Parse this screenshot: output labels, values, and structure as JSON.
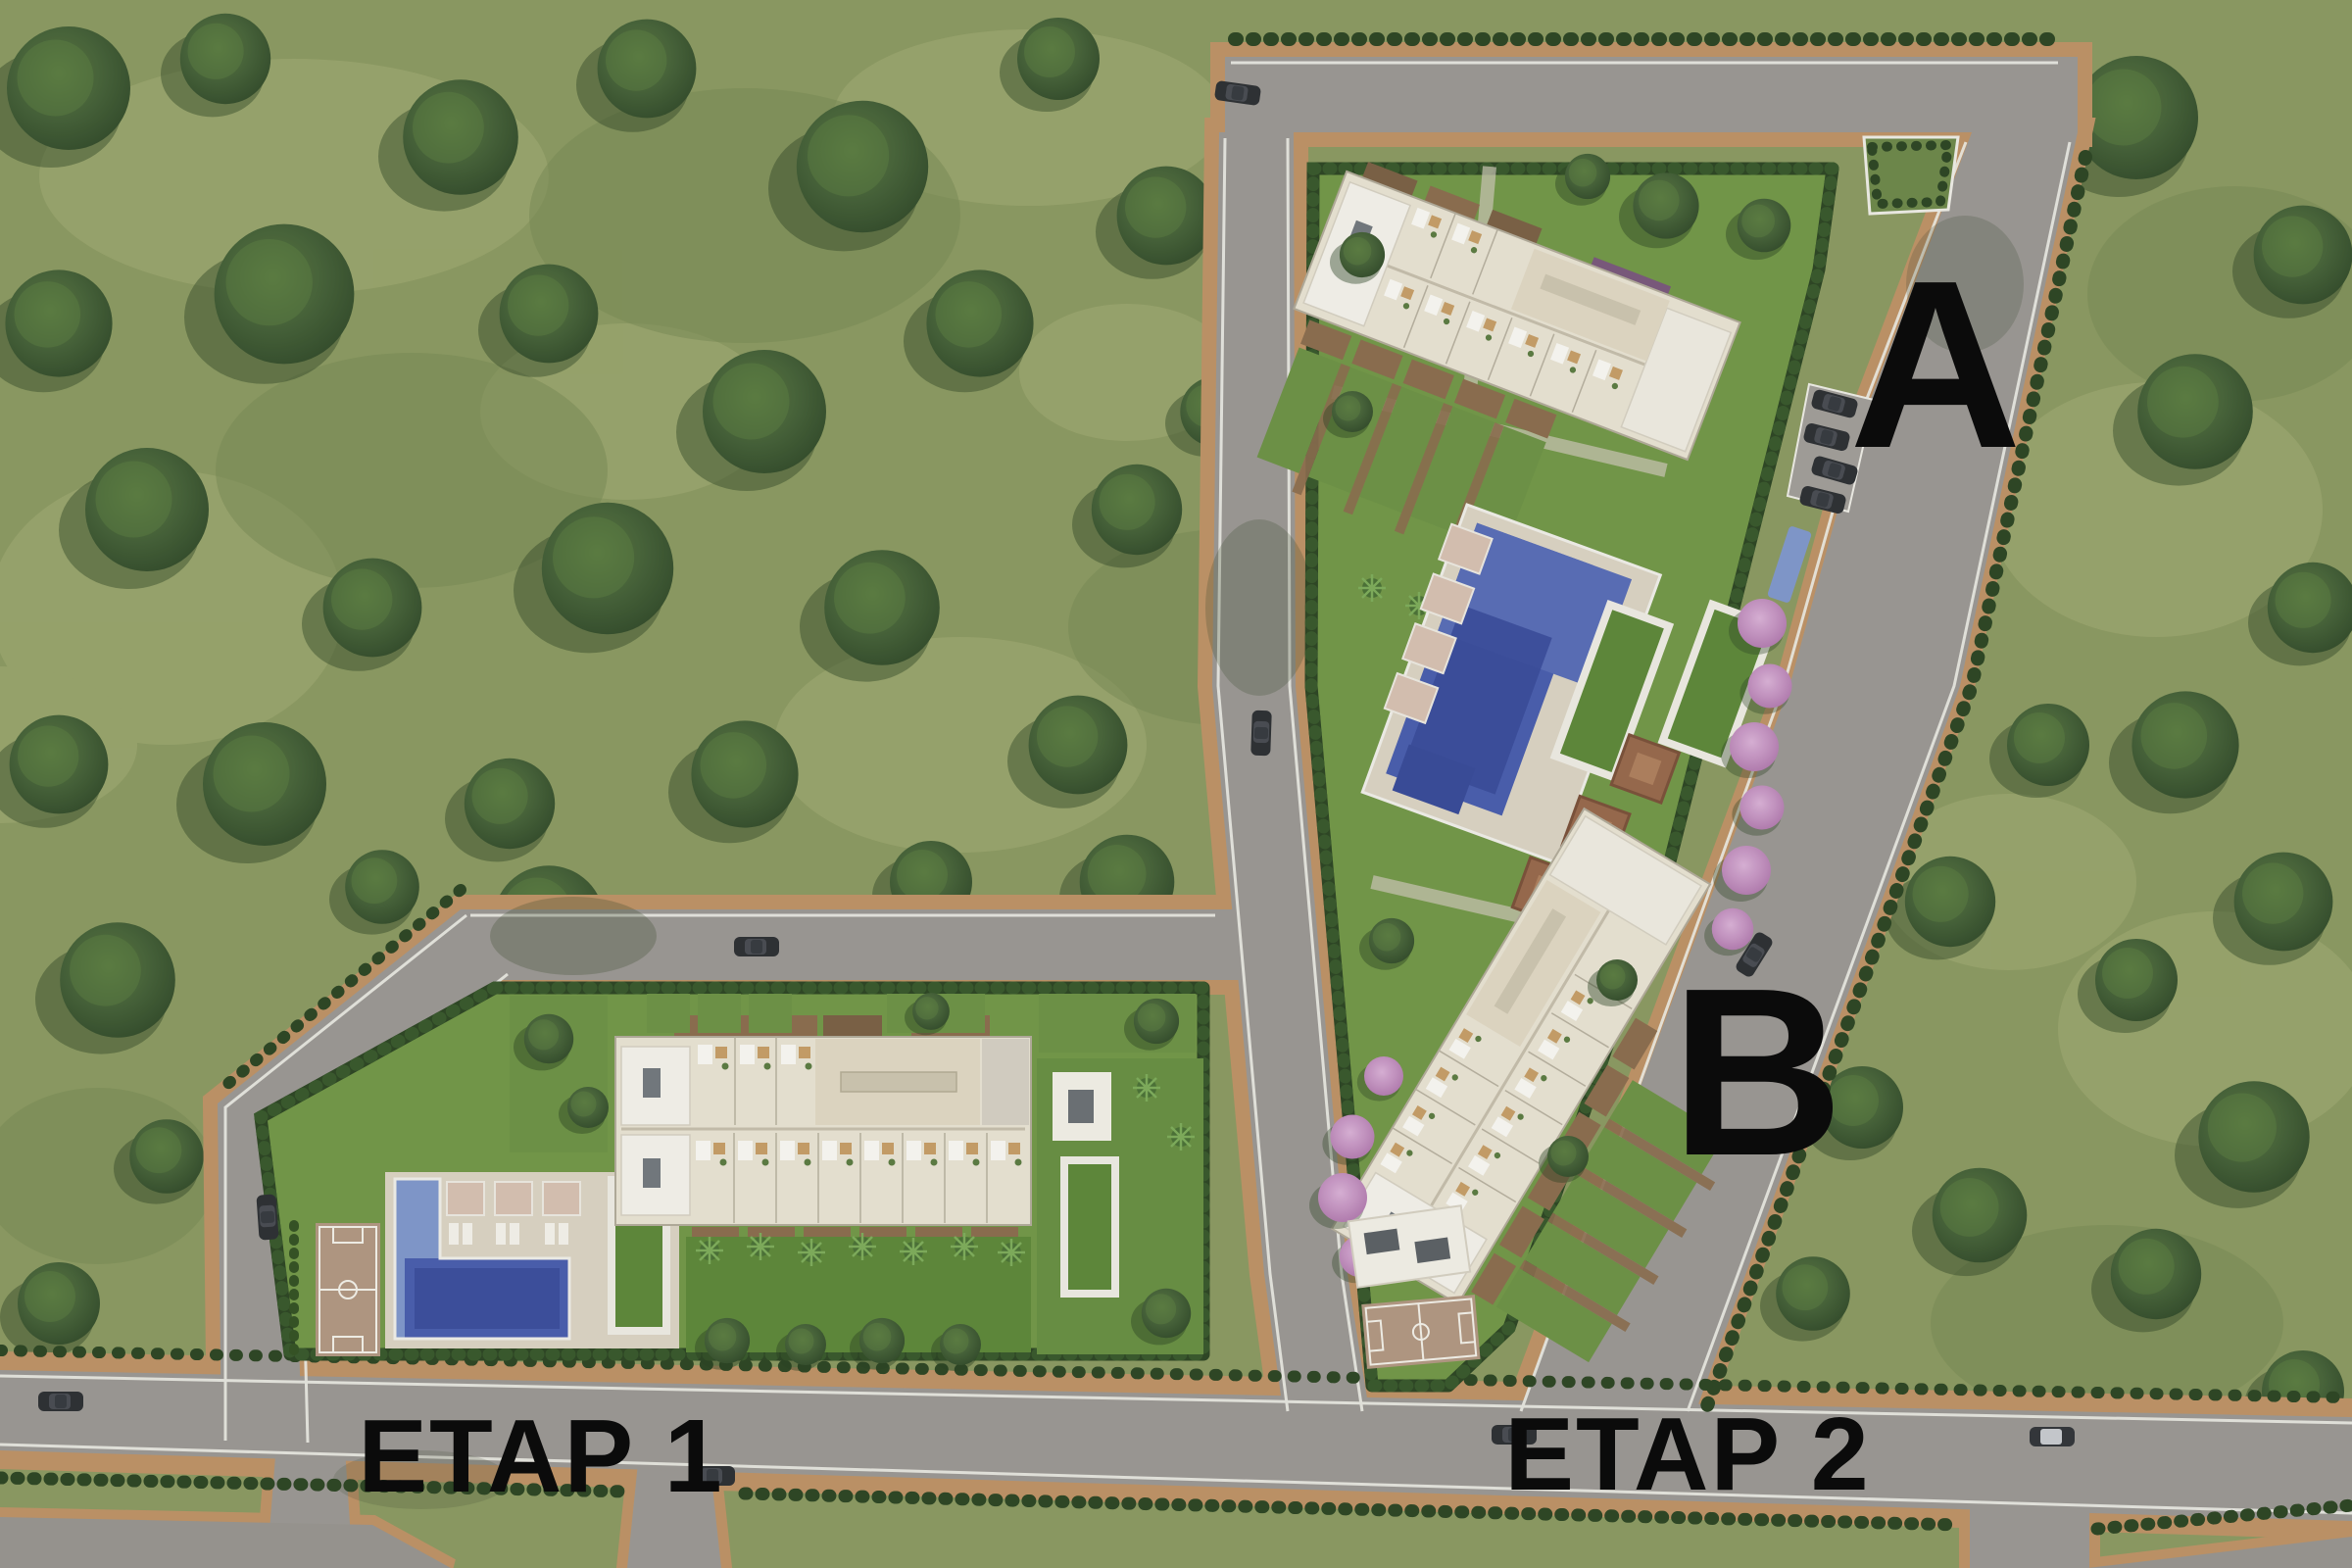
{
  "scene": {
    "type": "aerial-site-plan-render",
    "phases": [
      "ETAP 1",
      "ETAP 2"
    ],
    "blocks": [
      "A",
      "B"
    ]
  },
  "labels": {
    "block_a": "A",
    "block_b": "B",
    "phase1": "ETAP 1",
    "phase2": "ETAP 2"
  },
  "features": {
    "phase1": [
      "townhouse-row-building",
      "l-shaped-pool",
      "basketball-court",
      "green-roof-pavilions",
      "lawn"
    ],
    "phase2": [
      "block-a-townhouse-row",
      "central-pool-terrace",
      "pergolas",
      "block-b-townhouse-row",
      "basketball-court",
      "pink-flowering-trees"
    ],
    "visible_vehicle_count": 13
  },
  "colors": {
    "forest_grass": "#8d9c64",
    "grass_patch": "#a7b079",
    "tree_canopy": "#45613a",
    "road": "#9d9a96",
    "sidewalk": "#c09469",
    "curb_line": "#f0efe9",
    "hedge": "#2e4726",
    "parcel_lawn": "#74994a",
    "lawn_dark": "#5f8a3c",
    "building": "#ebe5d6",
    "roof_white": "#f6f4ee",
    "terrace": "#e2dac6",
    "deck_brown": "#8d6f51",
    "pool_blue": "#4a5fb0",
    "pool_dark": "#3a4c9c",
    "pool_light": "#8299cf",
    "court_tan": "#b49a85",
    "pink_tree": "#c391c6",
    "car_dark": "#2e3136",
    "label_text": "#0b0b0b"
  }
}
